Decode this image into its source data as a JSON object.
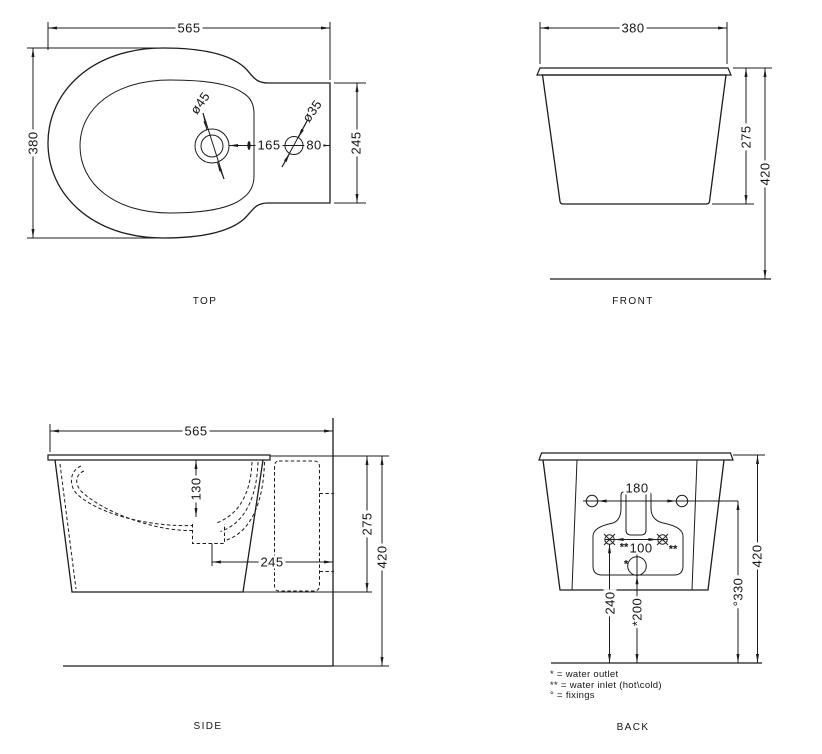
{
  "views": {
    "top": {
      "label": "TOP",
      "width": "565",
      "depth": "380",
      "tap_hole_diameter": "ø45",
      "side_hole_diameter": "ø35",
      "hole_spacing": "165",
      "hole_edge_offset": "80",
      "spud_section_height": "245"
    },
    "front": {
      "label": "FRONT",
      "width": "380",
      "body_height": "275",
      "total_height": "420"
    },
    "side": {
      "label": "SIDE",
      "length": "565",
      "basin_depth": "130",
      "drain_to_wall": "245",
      "body_height": "275",
      "total_height": "420"
    },
    "back": {
      "label": "BACK",
      "fixing_spacing": "180",
      "inlet_spacing": "100",
      "inlet_marker_left": "**",
      "inlet_marker_right": "**",
      "outlet_marker": "*",
      "inlet_height": "240",
      "outlet_height": "*200",
      "fixing_height": "°330",
      "total_height": "420"
    }
  },
  "legend": {
    "water_outlet": "* = water outlet",
    "water_inlet": "** = water inlet (hot\\cold)",
    "fixings": "° = fixings"
  }
}
